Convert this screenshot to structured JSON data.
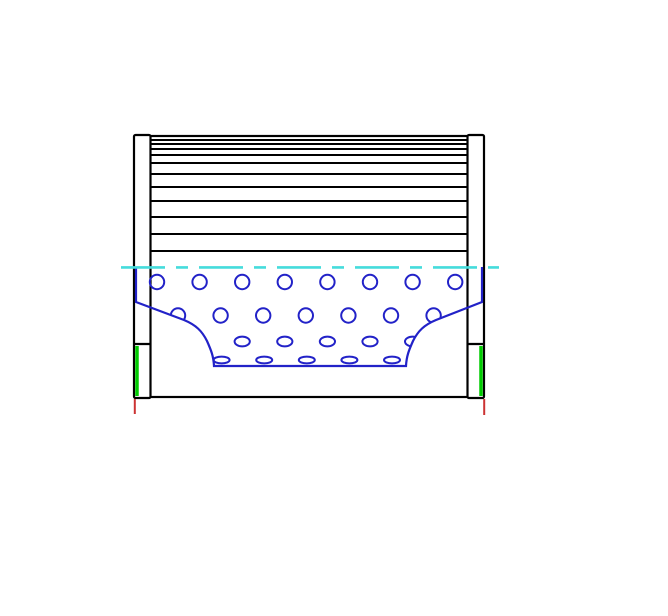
{
  "drawing": {
    "kind": "technical-drawing-filter-element-side-section",
    "canvas": {
      "width": 668,
      "height": 616,
      "background": "#ffffff"
    },
    "colors": {
      "outline": "#000000",
      "core": "#2222c8",
      "centerline": "#45dcdc",
      "seal": "#00cb00",
      "datum": "#cc3333"
    },
    "strokes": {
      "outline": 2.2,
      "pleat": 2,
      "core": 2,
      "centerline": 2.6,
      "seal": 3.5,
      "datum": 2
    },
    "geometry": {
      "body": {
        "x": 150,
        "y": 136,
        "w": 318,
        "h": 261
      },
      "caps": {
        "left": {
          "x": 134,
          "y": 135,
          "w": 16.5,
          "h": 263
        },
        "right": {
          "x": 467.5,
          "y": 135,
          "w": 16.5,
          "h": 263
        }
      },
      "cap_tick_y": 344,
      "pleat_lines_y": [
        140,
        144,
        149,
        155,
        163,
        174,
        187,
        201,
        217,
        234,
        251
      ],
      "centerline": {
        "y": 267.4,
        "x1": 121,
        "x2": 499,
        "dash": "44 11 12 11"
      },
      "core": {
        "outline_path": "M 136 267 L 136 302 L 184 320 C 196 325 202 331 207 341 C 211 350 213.5 356 214 366 L 406 366 C 406.5 356 409 350 413 341 C 418 331 424 325 436 320 L 482 302 L 482 267",
        "hole_rows": [
          {
            "shape": "circle",
            "cy": 282,
            "x0": 157,
            "dx": 42.6,
            "n": 8,
            "rx": 7.2,
            "ry": 7.2
          },
          {
            "shape": "circle",
            "cy": 315.5,
            "x0": 178,
            "dx": 42.6,
            "n": 7,
            "rx": 7.2,
            "ry": 7.2
          },
          {
            "shape": "ellipse",
            "cy": 341.5,
            "x0": 242.2,
            "dx": 42.6,
            "n": 5,
            "rx": 7.6,
            "ry": 4.9
          },
          {
            "shape": "ellipse",
            "cy": 360,
            "x0": 221.6,
            "dx": 42.6,
            "n": 5,
            "rx": 8,
            "ry": 3.4
          }
        ]
      },
      "seal_lines": [
        {
          "side": "left",
          "x": 137,
          "y1": 346,
          "y2": 396
        },
        {
          "side": "right",
          "x": 481,
          "y1": 346,
          "y2": 396
        }
      ],
      "datum_lines": [
        {
          "side": "left",
          "x": 134.8,
          "y1": 399,
          "y2": 414
        },
        {
          "side": "right",
          "x": 484.2,
          "y1": 399,
          "y2": 415
        }
      ]
    }
  }
}
